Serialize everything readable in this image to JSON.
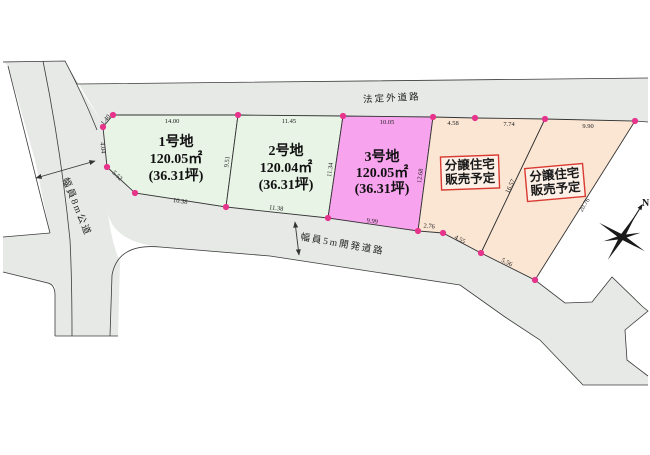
{
  "map": {
    "roads": {
      "top_road_label": "法定外道路",
      "left_road_label": "幅員8m公道",
      "dev_road_label": "幅員5m開発道路"
    },
    "plots": [
      {
        "name": "1号地",
        "area": "120.05㎡",
        "tsubo": "(36.31坪)"
      },
      {
        "name": "2号地",
        "area": "120.04㎡",
        "tsubo": "(36.31坪)"
      },
      {
        "name": "3号地",
        "area": "120.05㎡",
        "tsubo": "(36.31坪)"
      }
    ],
    "sale_plots": [
      {
        "line1": "分譲住宅",
        "line2": "販売予定"
      },
      {
        "line1": "分譲住宅",
        "line2": "販売予定"
      }
    ],
    "dims": {
      "p1_top": "14.00",
      "p1_left1": "1.40",
      "p1_left2": "4.04",
      "p1_left3": "5.52",
      "p1_bottom": "10.38",
      "p1_right": "9.51",
      "p2_top": "11.45",
      "p2_bottom": "11.38",
      "p2_right": "11.34",
      "p3_top": "10.05",
      "p3_bottom": "9.99",
      "p3_right": "12.68",
      "o1_top1": "4.58",
      "o1_top2": "7.74",
      "o1_bottom1": "2.76",
      "o1_bottom2": "4.55",
      "o1_right": "16.57",
      "o2_top": "9.90",
      "o2_bottom": "5.56",
      "o2_right": "20.76"
    },
    "compass_label": "N",
    "colors": {
      "road_gray": "#e6e9e6",
      "plot_green": "#e8f4e6",
      "plot_pink": "#f8a3ee",
      "plot_peach": "#fbe6d3",
      "boundary_dot": "#e6338c",
      "sale_label_red": "#d93a31",
      "line": "#3c3c3c"
    }
  }
}
